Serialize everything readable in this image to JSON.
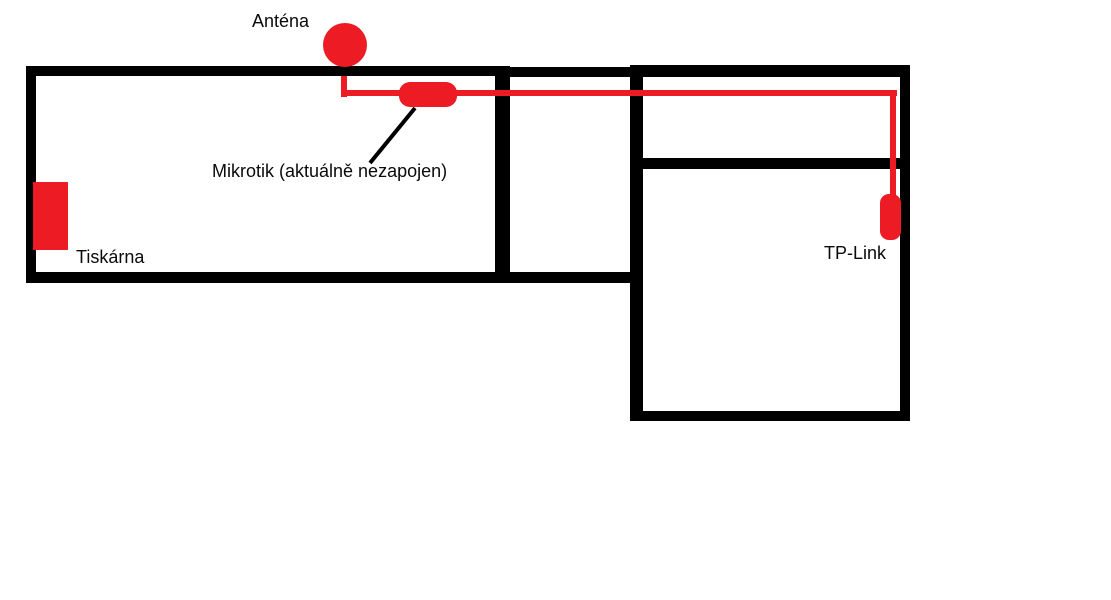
{
  "diagram": {
    "labels": {
      "antenna": "Anténa",
      "mikrotik": "Mikrotik (aktuálně nezapojen)",
      "printer": "Tiskárna",
      "tplink": "TP-Link"
    },
    "colors": {
      "device_red": "#ed1c24",
      "wall_black": "#000000",
      "text_color": "#0a0a0a",
      "background": "#ffffff"
    },
    "nodes": [
      {
        "id": "antenna",
        "type": "antenna-dot",
        "label": "Anténa"
      },
      {
        "id": "mikrotik",
        "type": "inline-device",
        "label": "Mikrotik (aktuálně nezapojen)"
      },
      {
        "id": "printer",
        "type": "device-box",
        "label": "Tiskárna"
      },
      {
        "id": "tplink",
        "type": "wall-device",
        "label": "TP-Link"
      }
    ],
    "edges": [
      {
        "from": "antenna",
        "to": "mikrotik",
        "style": "red-cable"
      },
      {
        "from": "mikrotik",
        "to": "tplink",
        "style": "red-cable"
      }
    ]
  }
}
